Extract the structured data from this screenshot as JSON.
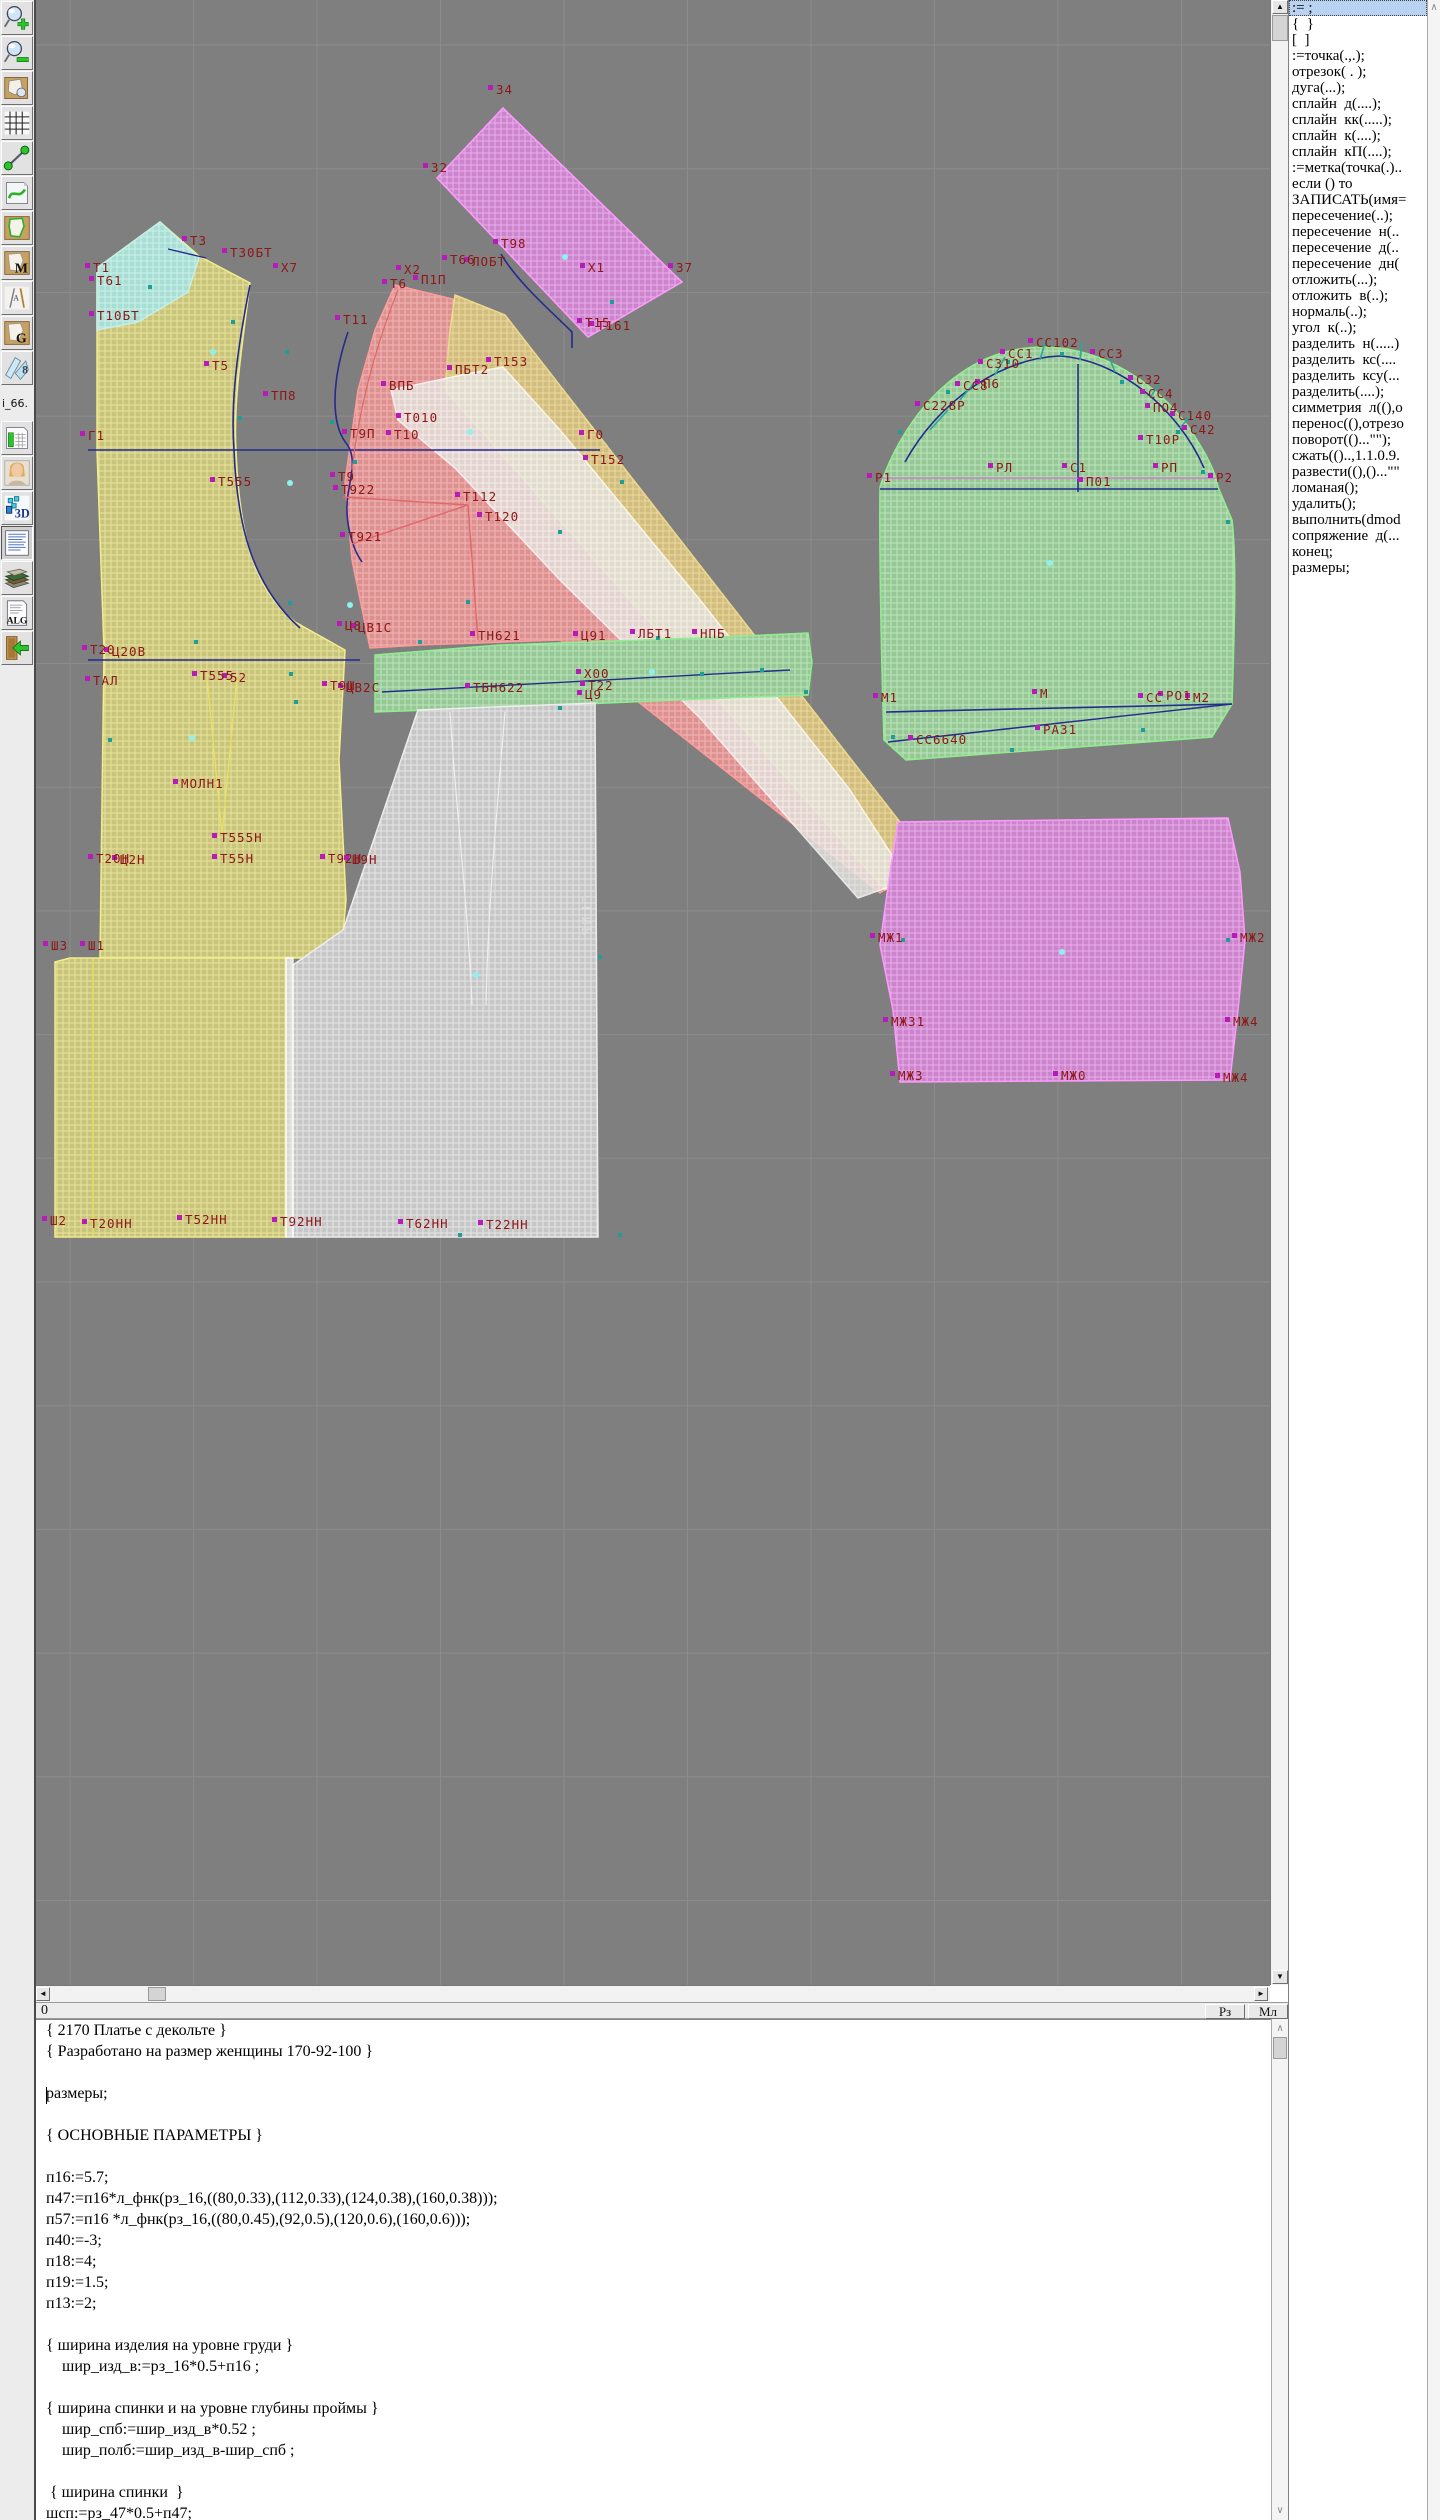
{
  "toolbar": {
    "items": [
      {
        "name": "zoom-in-icon",
        "icon": "zoomin"
      },
      {
        "name": "zoom-out-icon",
        "icon": "zoomout"
      },
      {
        "name": "pattern-sheet-icon",
        "icon": "sheet"
      },
      {
        "name": "grid-icon",
        "icon": "grid"
      },
      {
        "name": "measure-icon",
        "icon": "measure"
      },
      {
        "name": "page-curve-icon",
        "icon": "pagecurve"
      },
      {
        "name": "pattern-outline-icon",
        "icon": "patgreen"
      },
      {
        "name": "pattern-m-icon",
        "icon": "letter",
        "label": "M"
      },
      {
        "name": "drafting-tools-icon",
        "icon": "drafting",
        "label": "A"
      },
      {
        "name": "pattern-g-icon",
        "icon": "letter",
        "label": "G"
      },
      {
        "name": "ruler-8-icon",
        "icon": "blue8",
        "label": "8"
      },
      {
        "name": "i66-label",
        "icon": "i66",
        "label": "i_66."
      },
      {
        "name": "size-table-icon",
        "icon": "chart"
      },
      {
        "name": "model-photo-icon",
        "icon": "portrait"
      },
      {
        "name": "3d-icon",
        "icon": "threed",
        "label": "3D"
      },
      {
        "name": "text-document-icon",
        "icon": "textdoc",
        "pressed": true
      },
      {
        "name": "books-icon",
        "icon": "books"
      },
      {
        "name": "alg-document-icon",
        "icon": "alg",
        "label": "ALG"
      },
      {
        "name": "exit-icon",
        "icon": "exit"
      }
    ]
  },
  "panel": {
    "selected_index": 0,
    "items": [
      ":= ;",
      "{  }",
      "[  ]",
      ":=точка(.,.);",
      "отрезок( . );",
      "дуга(...);",
      "сплайн  д(....);",
      "сплайн  кк(.....);",
      "сплайн  к(....);",
      "сплайн  кП(....);",
      ":=метка(точка(.)..",
      "если () то",
      "ЗАПИСАТЬ(имя=",
      "пересечение(..);",
      "пересечение  н(..",
      "пересечение  д(..",
      "пересечение  дн(",
      "отложить(...);",
      "отложить  в(..);",
      "нормаль(..);",
      "угол  к(..);",
      "разделить  н(.....)",
      "разделить  кс(....",
      "разделить  ксу(...",
      "разделить(....);",
      "симметрия  л((),о",
      "перенос((),отрезо",
      "поворот(()...\"\");",
      "сжать(()..,1.1.0.9.",
      "развести((),()...\"\"",
      "ломаная();",
      "удалить();",
      "выполнить(dmod",
      "сопряжение  д(...",
      "конец;",
      "размеры;"
    ]
  },
  "statusbar": {
    "left": "0",
    "buttons": [
      "Рз",
      "Мл"
    ]
  },
  "scrollbars": {
    "up": "▲",
    "down": "▼",
    "left": "◄",
    "right": "►",
    "thin_up": "∧",
    "thin_down": "∨"
  },
  "editor": {
    "lines": [
      "{ 2170 Платье с декольте }",
      "{ Разработано на размер женщины 170-92-100 }",
      "",
      "размеры;",
      "",
      "{ ОСНОВНЫЕ ПАРАМЕТРЫ }",
      "",
      "п16:=5.7;",
      "п47:=п16*л_фнк(рз_16,((80,0.33),(112,0.33),(124,0.38),(160,0.38)));",
      "п57:=п16 *л_фнк(рз_16,((80,0.45),(92,0.5),(120,0.6),(160,0.6)));",
      "п40:=-3;",
      "п18:=4;",
      "п19:=1.5;",
      "п13:=2;",
      "",
      "{ ширина изделия на уровне груди }",
      "    шир_изд_в:=рз_16*0.5+п16 ;",
      "",
      "{ ширина спинки и на уровне глубины проймы }",
      "    шир_спб:=шир_изд_в*0.52 ;",
      "    шир_полб:=шир_изд_в-шир_спб ;",
      "",
      " { ширина спинки  }",
      "шсп:=рз_47*0.5+п47;"
    ]
  },
  "canvas": {
    "background": "#7f7f7f",
    "grid": {
      "x0": 70,
      "dx": 123.5,
      "y0": 45,
      "dy": 123.7,
      "color": "#8c8c8c"
    },
    "label_color": "#8e1616",
    "marker_color": "#b81cb8",
    "teal_color": "#1d9e96",
    "dot_color": "#8df2ef",
    "palette": {
      "yellow": {
        "base": "#c9c47c",
        "line": "#e9e49c",
        "stroke": "#f2ee8a"
      },
      "cyan": {
        "base": "#a9ded5",
        "line": "#ccf0ea",
        "stroke": "#c6efe8"
      },
      "red": {
        "base": "#dd9090",
        "line": "#f2b6b6",
        "stroke": "#ff9a9a"
      },
      "band": {
        "base": "#d2bd80",
        "line": "#ecd99c",
        "stroke": "#ecd98c"
      },
      "white": {
        "base": "#e4e2de",
        "line": "#f8f8f6",
        "stroke": "#ffffff"
      },
      "magenta": {
        "base": "#cc84cc",
        "line": "#e9aee9",
        "stroke": "#ff9aff"
      },
      "green": {
        "base": "#96c896",
        "line": "#bce6bc",
        "stroke": "#90ee90"
      },
      "gray": {
        "base": "#c6c6c6",
        "line": "#e6e6e6",
        "stroke": "#ededed"
      }
    },
    "pieces": [
      {
        "name": "front-bodice",
        "fill": "yellow",
        "path": "M97,268 L160,222 L199,256 L250,283 C243,340 233,400 236,450 C239,530 252,588 295,622 L345,650 L339,760 L346,900 L341,958 L100,958 L104,650 L97,450 Z"
      },
      {
        "name": "front-skirt-panel",
        "fill": "yellow",
        "path": "M70,958 L286,958 L286,1237 L55,1237 L55,962 Z"
      },
      {
        "name": "shoulder-patch",
        "fill": "cyan",
        "path": "M97,268 L160,222 L199,258 L188,292 L138,322 L97,330 Z"
      },
      {
        "name": "side-piece",
        "fill": "red",
        "path": "M395,285 L465,302 L925,862 L880,893 L560,640 L420,645 L370,648 L352,560 L345,482 L358,390 L375,330 Z"
      },
      {
        "name": "side-band",
        "fill": "band",
        "path": "M455,295 L505,315 L928,858 L885,890 L445,390 L450,330 Z"
      },
      {
        "name": "overlay-piece",
        "fill": "white",
        "opacity": 0.82,
        "path": "M391,390 L462,375 L503,367 L560,430 L700,600 L850,790 L908,880 L858,898 L700,718 L560,580 L455,468 L398,420 Z"
      },
      {
        "name": "belt-piece-rotated",
        "fill": "magenta",
        "path": "M437,178 L503,108 L682,282 L588,337 Z"
      },
      {
        "name": "waistband",
        "fill": "green",
        "path": "M375,655 L500,645 L700,638 L808,633 L812,662 L808,695 L700,699 L560,705 L430,710 L375,712 Z"
      },
      {
        "name": "back-skirt-panel",
        "fill": "gray",
        "path": "M418,710 L595,703 L598,1237 L293,1237 L293,965 L343,930 Z"
      },
      {
        "name": "fold-strip",
        "fill": "white",
        "opacity": 0.9,
        "path": "M286,958 L293,958 L293,1237 L286,1237 Z"
      },
      {
        "name": "sleeve",
        "fill": "green",
        "path": "M880,487 C890,455 912,415 942,388 C982,352 1022,344 1060,348 C1112,354 1162,388 1192,432 C1206,454 1215,470 1218,487 L1232,520 C1237,560 1234,640 1232,704 L1212,737 C1108,744 1006,752 906,760 L884,740 C882,680 879,560 880,487 Z"
      },
      {
        "name": "cuff-piece",
        "fill": "magenta",
        "path": "M898,822 L1228,818 L1240,872 L1245,940 L1238,1010 L1230,1080 L900,1082 L893,1010 L880,945 L890,872 Z"
      }
    ],
    "lines": [
      {
        "name": "chest-line",
        "color": "#242a8e",
        "w": 1.6,
        "path": "M88,450 L600,450"
      },
      {
        "name": "armhole-curve",
        "color": "#242a8e",
        "w": 1.6,
        "path": "M250,285 C240,335 230,395 234,450 C237,525 252,585 300,628"
      },
      {
        "name": "side-seam-curve",
        "color": "#242a8e",
        "w": 1.6,
        "path": "M348,332 C330,385 332,425 346,443 C356,455 352,472 348,494 C344,520 352,548 362,562"
      },
      {
        "name": "shoulder-tick",
        "color": "#242a8e",
        "w": 1.4,
        "path": "M168,249 L206,258"
      },
      {
        "name": "belt-curve",
        "color": "#242a8e",
        "w": 1.6,
        "path": "M501,254 C518,283 552,312 572,332 L572,348"
      },
      {
        "name": "waist-line",
        "color": "#242a8e",
        "w": 1.4,
        "path": "M88,660 L360,660"
      },
      {
        "name": "waistband-diagonal",
        "color": "#242a8e",
        "w": 1.4,
        "path": "M382,692 L790,670"
      },
      {
        "name": "biceps-line",
        "color": "#242a8e",
        "w": 1.6,
        "path": "M880,489 L1218,489"
      },
      {
        "name": "sleeve-center-line",
        "color": "#242a8e",
        "w": 1.6,
        "path": "M1078,364 L1078,492"
      },
      {
        "name": "sleeve-cap-curve",
        "color": "#242a8e",
        "w": 1.6,
        "path": "M905,462 C938,402 1000,358 1060,356 C1118,360 1178,408 1204,468"
      },
      {
        "name": "cuff-line",
        "color": "#242a8e",
        "w": 1.6,
        "path": "M886,712 L1232,704"
      },
      {
        "name": "cuff-diagonal",
        "color": "#242a8e",
        "w": 1.4,
        "path": "M888,742 L1232,704"
      },
      {
        "name": "dart-lines-pink",
        "color": "#e06868",
        "w": 1.4,
        "path": "M343,497 L468,505 M352,544 L468,505 M468,505 L478,640"
      },
      {
        "name": "side-piece-edge",
        "color": "#e06868",
        "w": 1.2,
        "path": "M398,290 C378,340 360,400 352,470"
      },
      {
        "name": "skirt-dart",
        "color": "#e8e262",
        "w": 1.3,
        "path": "M207,677 L222,835 L237,677"
      },
      {
        "name": "fold-line",
        "color": "#e8e262",
        "w": 1.3,
        "path": "M93,958 L93,1237"
      },
      {
        "name": "back-skirt-seam-1",
        "color": "#eeeeee",
        "w": 1.2,
        "path": "M450,712 C456,810 468,905 472,1005"
      },
      {
        "name": "back-skirt-seam-2",
        "color": "#eeeeee",
        "w": 1.2,
        "path": "M505,712 C497,810 488,905 486,1005"
      },
      {
        "name": "sleeve-magenta-line",
        "color": "#cf6ecf",
        "w": 1.2,
        "path": "M880,478 L1218,478"
      },
      {
        "name": "cap-notches",
        "color": "#2aa898",
        "w": 1.6,
        "path": "M930,430 L948,410 M960,400 L975,382 M995,375 L1005,357 M1040,360 L1045,342 M1080,360 L1082,342 M1115,372 L1108,354 M1150,398 L1160,382 M1180,428 L1192,414"
      }
    ],
    "labels": [
      [
        93,
        272,
        "Т1"
      ],
      [
        97,
        285,
        "Т61"
      ],
      [
        190,
        245,
        "Т3"
      ],
      [
        230,
        257,
        "Т30БТ"
      ],
      [
        281,
        272,
        "Х7"
      ],
      [
        97,
        320,
        "Т10БТ"
      ],
      [
        212,
        370,
        "Т5"
      ],
      [
        343,
        324,
        "Т11"
      ],
      [
        271,
        400,
        "ТП8"
      ],
      [
        88,
        440,
        "Г1"
      ],
      [
        390,
        288,
        "Т6"
      ],
      [
        404,
        274,
        "Х2"
      ],
      [
        421,
        284,
        "П1П"
      ],
      [
        496,
        94,
        "34"
      ],
      [
        431,
        172,
        "32"
      ],
      [
        588,
        272,
        "Х1"
      ],
      [
        676,
        272,
        "37"
      ],
      [
        585,
        327,
        "Т15"
      ],
      [
        597,
        330,
        "Т161"
      ],
      [
        501,
        248,
        "Т98"
      ],
      [
        450,
        264,
        "Т66"
      ],
      [
        472,
        266,
        "ЛОБТ"
      ],
      [
        494,
        366,
        "Т153"
      ],
      [
        455,
        374,
        "ПБТ2"
      ],
      [
        389,
        390,
        "ВПБ"
      ],
      [
        404,
        422,
        "Т010"
      ],
      [
        350,
        438,
        "Т9П"
      ],
      [
        394,
        439,
        "Т10"
      ],
      [
        587,
        439,
        "Г0"
      ],
      [
        591,
        464,
        "Т152"
      ],
      [
        338,
        481,
        "Т9"
      ],
      [
        341,
        494,
        "Т922"
      ],
      [
        463,
        501,
        "Т112"
      ],
      [
        485,
        521,
        "Т120"
      ],
      [
        348,
        541,
        "Т921"
      ],
      [
        218,
        486,
        "Т555"
      ],
      [
        345,
        630,
        "Ц8"
      ],
      [
        358,
        632,
        "ЦВ1С"
      ],
      [
        478,
        640,
        "ТН621"
      ],
      [
        581,
        640,
        "Ц91"
      ],
      [
        638,
        638,
        "ЛБТ1"
      ],
      [
        700,
        638,
        "НПБ"
      ],
      [
        584,
        678,
        "Х00"
      ],
      [
        588,
        690,
        "Т22"
      ],
      [
        585,
        699,
        "Ц9"
      ],
      [
        330,
        690,
        "Т9Ш"
      ],
      [
        346,
        692,
        "ЦВ2С"
      ],
      [
        473,
        692,
        "ТБН622"
      ],
      [
        90,
        654,
        "Т20"
      ],
      [
        112,
        656,
        "Ц20В"
      ],
      [
        93,
        685,
        "ТАЛ"
      ],
      [
        200,
        680,
        "Т555"
      ],
      [
        230,
        682,
        "52"
      ],
      [
        181,
        788,
        "МОЛН1"
      ],
      [
        220,
        842,
        "Т555Н"
      ],
      [
        220,
        863,
        "Т55Н"
      ],
      [
        96,
        863,
        "Т20Н"
      ],
      [
        120,
        864,
        "Ц2Н"
      ],
      [
        328,
        863,
        "Т92Н"
      ],
      [
        352,
        864,
        "Ш9Н"
      ],
      [
        51,
        950,
        "Ш3"
      ],
      [
        88,
        950,
        "Ш1"
      ],
      [
        50,
        1225,
        "Ш2"
      ],
      [
        90,
        1228,
        "Т20НН"
      ],
      [
        185,
        1224,
        "Т52НН"
      ],
      [
        280,
        1226,
        "Т92НН"
      ],
      [
        406,
        1228,
        "Т62НН"
      ],
      [
        486,
        1229,
        "Т22НН"
      ],
      [
        875,
        482,
        "Р1"
      ],
      [
        1216,
        482,
        "Р2"
      ],
      [
        996,
        472,
        "РЛ"
      ],
      [
        1070,
        472,
        "С1"
      ],
      [
        1086,
        486,
        "П01"
      ],
      [
        1161,
        472,
        "РП"
      ],
      [
        1036,
        347,
        "СС102"
      ],
      [
        1008,
        358,
        "СС1"
      ],
      [
        986,
        368,
        "С310"
      ],
      [
        1098,
        358,
        "СС3"
      ],
      [
        1136,
        384,
        "С32"
      ],
      [
        1148,
        398,
        "СС4"
      ],
      [
        1178,
        420,
        "С140"
      ],
      [
        1190,
        434,
        "С42"
      ],
      [
        1146,
        444,
        "Т10Р"
      ],
      [
        1153,
        412,
        "ПО4"
      ],
      [
        963,
        390,
        "СС8"
      ],
      [
        983,
        388,
        "П6"
      ],
      [
        923,
        410,
        "С228Р"
      ],
      [
        881,
        702,
        "М1"
      ],
      [
        1040,
        698,
        "М"
      ],
      [
        1146,
        702,
        "СС"
      ],
      [
        1166,
        700,
        "РО1"
      ],
      [
        1193,
        702,
        "М2"
      ],
      [
        916,
        744,
        "СС6640"
      ],
      [
        1043,
        734,
        "РА31"
      ],
      [
        878,
        942,
        "МЖ1"
      ],
      [
        1240,
        942,
        "МЖ2"
      ],
      [
        891,
        1026,
        "МЖ31"
      ],
      [
        1233,
        1026,
        "МЖ4"
      ],
      [
        898,
        1080,
        "МЖ3"
      ],
      [
        1061,
        1080,
        "МЖ0"
      ],
      [
        1223,
        1082,
        "МЖ4"
      ]
    ],
    "vertical_label": {
      "text": "СГИБ",
      "x": 582,
      "y": 895,
      "color": "#dddddd"
    },
    "teal_markers": [
      [
        150,
        287
      ],
      [
        233,
        322
      ],
      [
        287,
        352
      ],
      [
        240,
        418
      ],
      [
        332,
        422
      ],
      [
        355,
        462
      ],
      [
        420,
        642
      ],
      [
        468,
        602
      ],
      [
        560,
        532
      ],
      [
        622,
        482
      ],
      [
        658,
        638
      ],
      [
        702,
        674
      ],
      [
        762,
        670
      ],
      [
        806,
        692
      ],
      [
        560,
        708
      ],
      [
        600,
        957
      ],
      [
        620,
        1235
      ],
      [
        460,
        1235
      ],
      [
        291,
        674
      ],
      [
        296,
        702
      ],
      [
        110,
        740
      ],
      [
        196,
        642
      ],
      [
        290,
        603
      ],
      [
        612,
        302
      ],
      [
        900,
        432
      ],
      [
        948,
        392
      ],
      [
        1008,
        362
      ],
      [
        1062,
        354
      ],
      [
        1122,
        382
      ],
      [
        1178,
        432
      ],
      [
        1203,
        472
      ],
      [
        1228,
        522
      ],
      [
        893,
        737
      ],
      [
        1012,
        750
      ],
      [
        1143,
        730
      ],
      [
        1228,
        940
      ],
      [
        903,
        940
      ]
    ],
    "cyan_dots": [
      [
        213,
        352
      ],
      [
        290,
        483
      ],
      [
        565,
        257
      ],
      [
        470,
        432
      ],
      [
        1050,
        563
      ],
      [
        1062,
        952
      ],
      [
        476,
        975
      ],
      [
        192,
        738
      ],
      [
        652,
        672
      ],
      [
        350,
        605
      ]
    ]
  }
}
